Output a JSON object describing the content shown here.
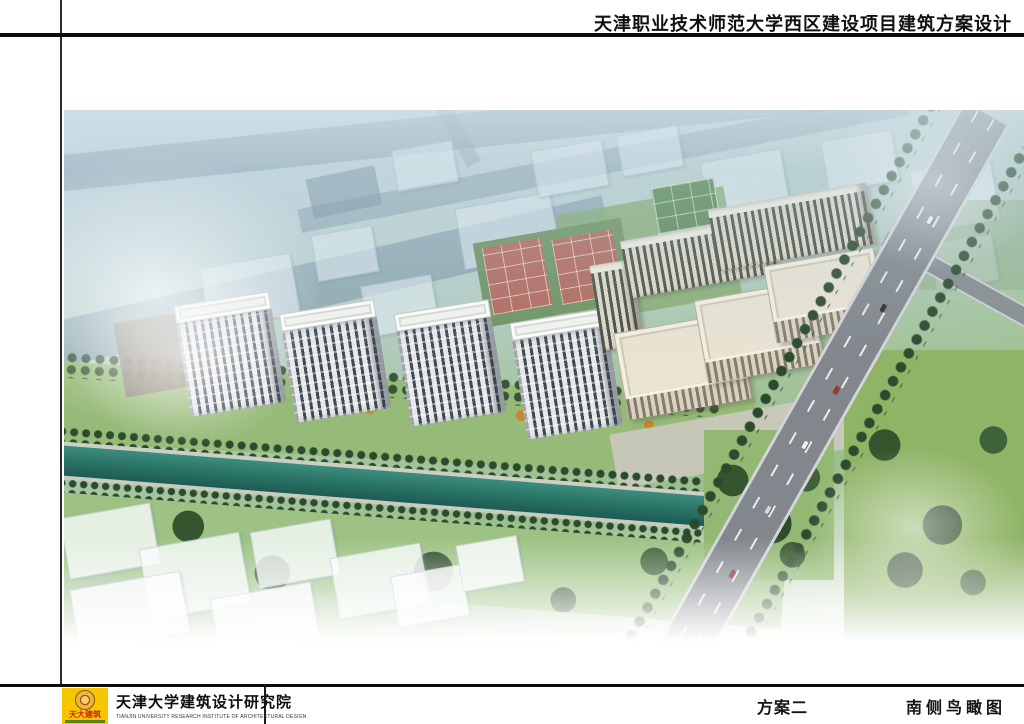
{
  "header": {
    "title": "天津职业技术师范大学西区建设项目建筑方案设计"
  },
  "footer": {
    "logo": {
      "seal_text": "天大建筑",
      "bg_color": "#f7c600",
      "text_color": "#c81f1f"
    },
    "institute_cn": "天津大学建筑设计研究院",
    "institute_en": "TIANJIN UNIVERSITY RESEARCH INSTITUTE OF ARCHITECTURAL DESIGN",
    "scheme_label": "方案二",
    "view_label": "南侧鸟瞰图"
  },
  "rendering": {
    "colors": {
      "river_water": "#2a7568",
      "lawn_green": "#96ba77",
      "tree_green": "#2c4a2e",
      "road_gray": "#81878c",
      "court_red": "#b26a5e",
      "court_green": "#5d8a55",
      "facade_dark": "#3f4a55",
      "facade_cream": "#e9e3d2",
      "haze_blue": "#c9dae2"
    }
  }
}
